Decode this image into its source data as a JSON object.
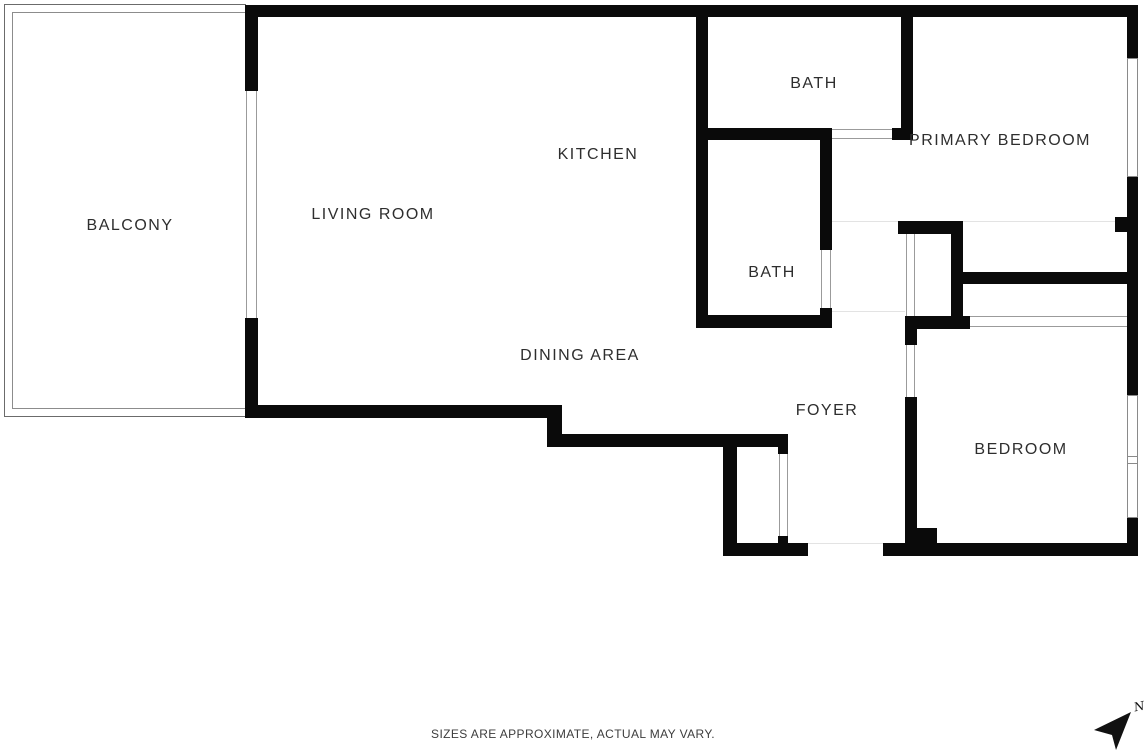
{
  "floor_plan": {
    "labels": {
      "balcony": "BALCONY",
      "living_room": "LIVING ROOM",
      "kitchen": "KITCHEN",
      "dining_area": "DINING AREA",
      "bath_top": "BATH",
      "bath_mid": "BATH",
      "primary_bedroom": "PRIMARY BEDROOM",
      "foyer": "FOYER",
      "bedroom": "BEDROOM"
    },
    "disclaimer": "SIZES ARE APPROXIMATE, ACTUAL MAY VARY.",
    "compass": {
      "north_label": "N",
      "direction": "northeast"
    },
    "colors": {
      "wall": "#0a0a0a",
      "label_text": "#2e2e2e",
      "door_line": "#9b9b9b",
      "faint_line": "#e3e3e3",
      "balcony_border": "#6b6b6b",
      "background": "#ffffff"
    }
  }
}
